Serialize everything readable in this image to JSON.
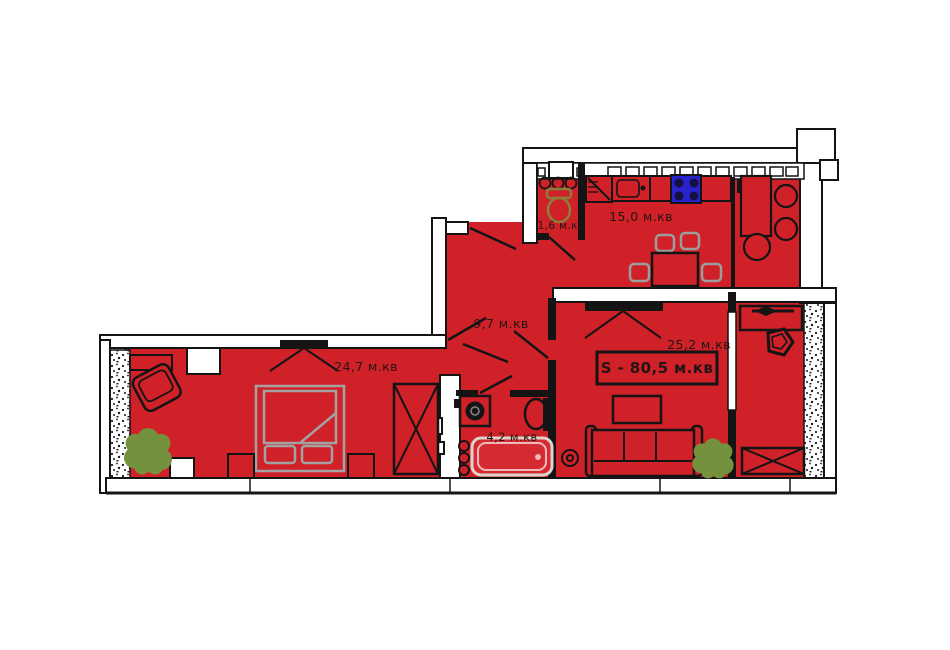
{
  "page": {
    "background": "#ffffff"
  },
  "floor_plan": {
    "units_suffix": "м.кв",
    "total_area": {
      "label": "S - 80,5 м.кв"
    },
    "rooms": [
      {
        "id": "wc",
        "label": "1,6 м.кв"
      },
      {
        "id": "kitchen",
        "label": "15,0 м.кв"
      },
      {
        "id": "hallway",
        "label": "9,7 м.кв"
      },
      {
        "id": "bathroom",
        "label": "4,2 м.кв"
      },
      {
        "id": "bedroom",
        "label": "24,7 м.кв"
      },
      {
        "id": "living_room",
        "label": "25,2 м.кв"
      }
    ],
    "colors": {
      "floor_red": "#cf2127",
      "wall_black": "#141414",
      "furniture_gray": "#9d9d9d",
      "plant_green": "#74923e",
      "toilet_olive": "#8d7c3e",
      "stove_blue": "#2822cc",
      "bath_rim_pink": "#f0b9b9",
      "hatch_dots": "#1a1a1a"
    },
    "furniture_icons": [
      "toilet",
      "stove",
      "fridge",
      "kitchen-sink",
      "bar-counter",
      "stools",
      "round-table",
      "dining-table",
      "chairs",
      "wardrobe",
      "bed",
      "nightstands",
      "armchair",
      "shelf",
      "plant",
      "sofa",
      "coffee-table",
      "speaker",
      "washing-machine",
      "bathroom-sink",
      "bathtub",
      "towel-rings",
      "desk",
      "balcony-chair",
      "balcony-wardrobe"
    ]
  }
}
